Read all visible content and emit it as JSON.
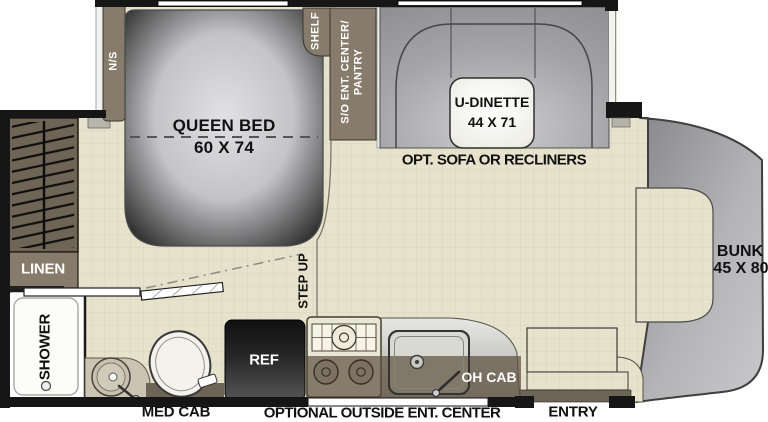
{
  "floorplan": {
    "labels": {
      "ns": "N/S",
      "shelf": "SHELF",
      "pantry_line1": "S/O ENT. CENTER/",
      "pantry_line2": "PANTRY",
      "queen_bed_line1": "QUEEN BED",
      "queen_bed_line2": "60 X 74",
      "dinette_line1": "U-DINETTE",
      "dinette_line2": "44 X 71",
      "opt_sofa": "OPT. SOFA OR RECLINERS",
      "linen": "LINEN",
      "shower": "SHOWER",
      "med_cab": "MED CAB",
      "ref": "REF",
      "step_up": "STEP UP",
      "oh_cab": "OH CAB",
      "optional_outside": "OPTIONAL OUTSIDE ENT. CENTER",
      "entry": "ENTRY",
      "bunk_line1": "BUNK",
      "bunk_line2": "45 X 80"
    },
    "colors": {
      "floor": "#e6e2cc",
      "floor_grid": "#d9d4bd",
      "cabinet_brown": "#877b6b",
      "wardrobe_brown": "#6f6557",
      "furniture_gray": "#a9a9ab",
      "wall_black": "#161616",
      "ref_black": "#1b1b1b",
      "oh_cab_overlay": "rgba(92,78,61,0.70)"
    }
  }
}
